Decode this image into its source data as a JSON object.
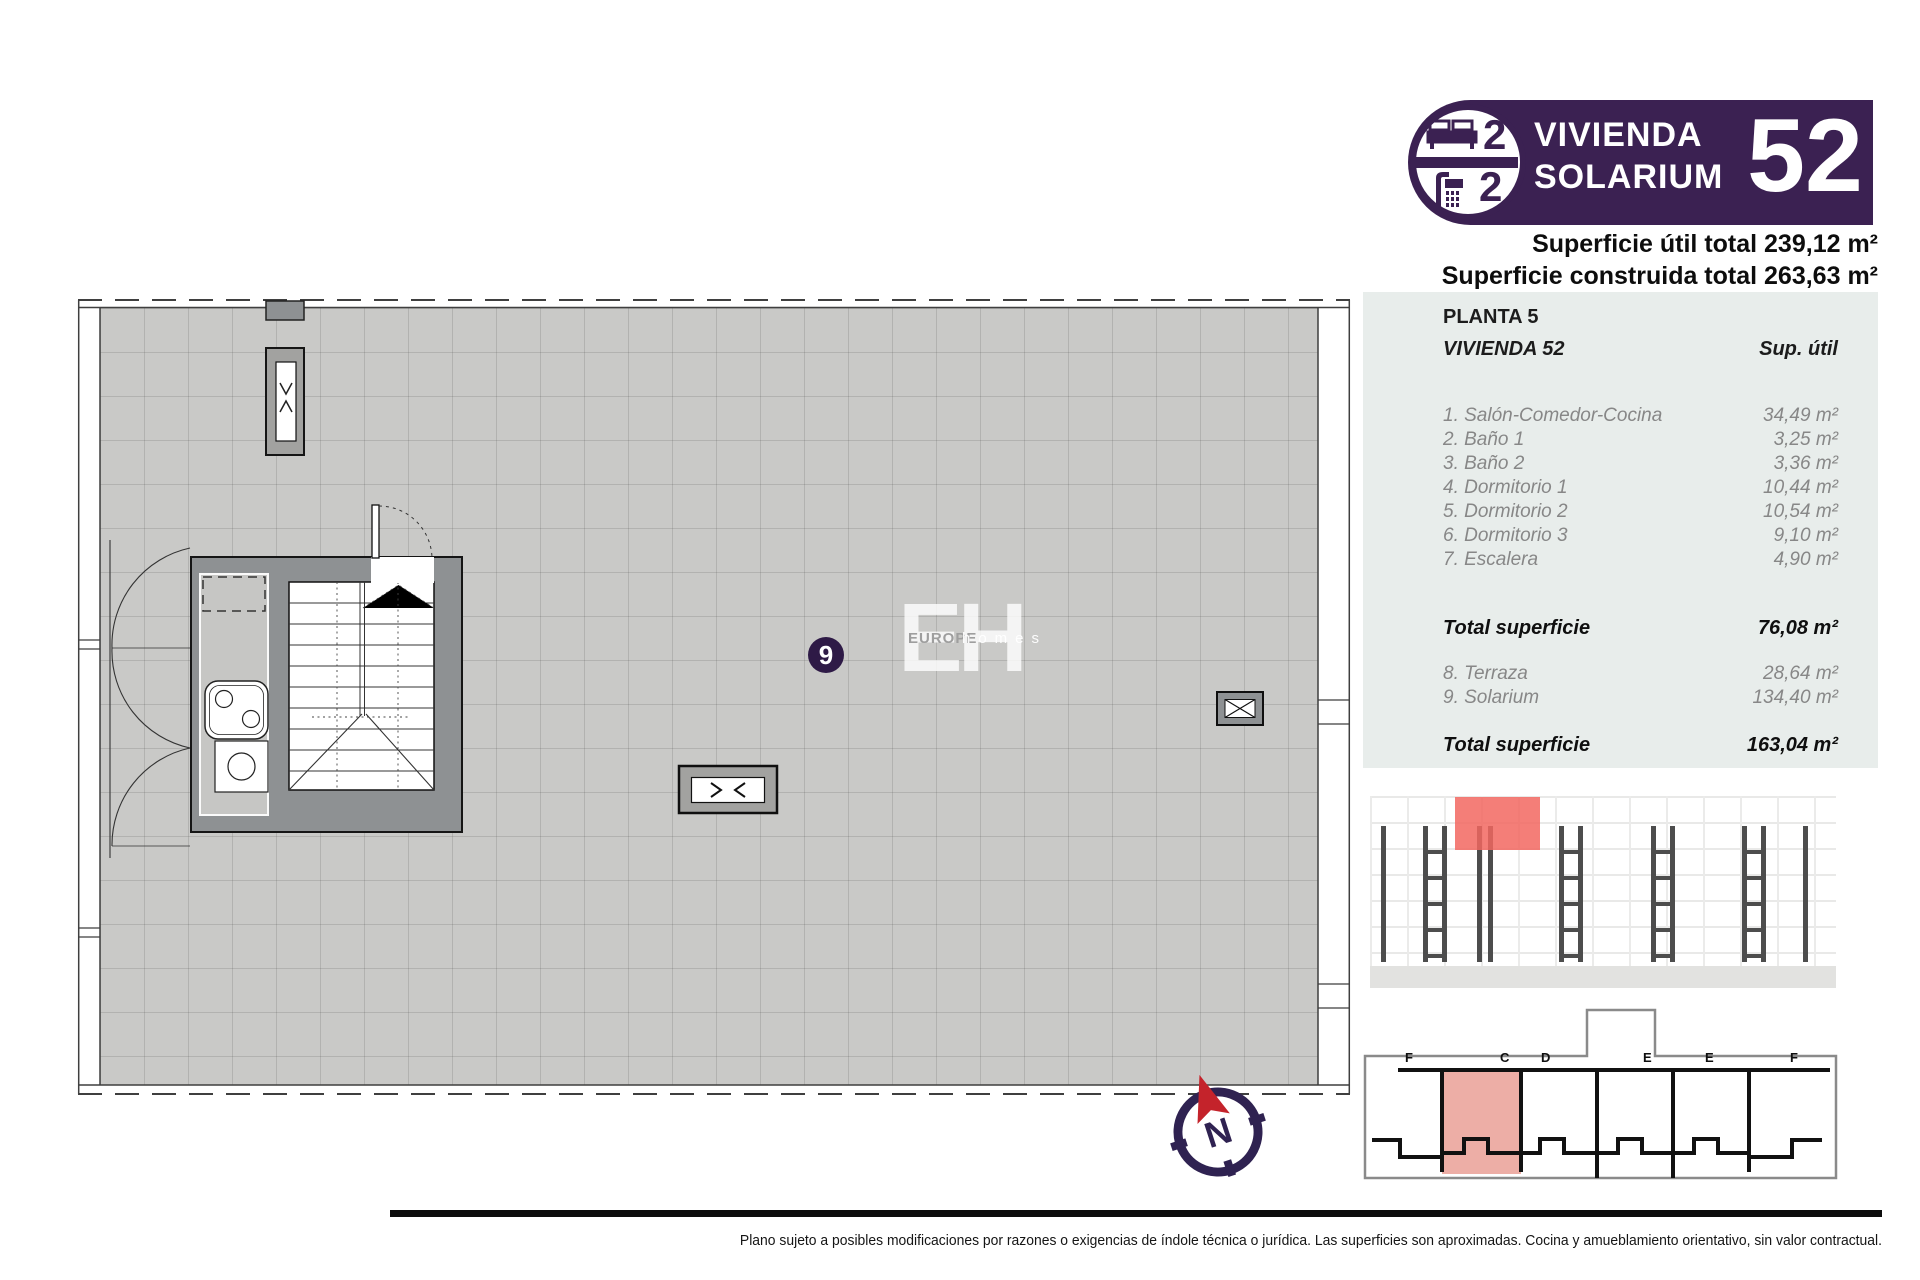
{
  "badge": {
    "bedrooms": "2",
    "bathrooms": "2",
    "title_line1": "VIVIENDA",
    "title_line2": "SOLARIUM",
    "number": "52"
  },
  "totals": {
    "util": "Superficie útil total 239,12 m²",
    "construida": "Superficie construida total 263,63 m²"
  },
  "table": {
    "floor": "PLANTA 5",
    "unit": "VIVIENDA 52",
    "column": "Sup. útil",
    "rooms": [
      {
        "label": "1. Salón-Comedor-Cocina",
        "area": "34,49 m²"
      },
      {
        "label": "2. Baño 1",
        "area": "3,25 m²"
      },
      {
        "label": "3. Baño 2",
        "area": "3,36 m²"
      },
      {
        "label": "4. Dormitorio 1",
        "area": "10,44 m²"
      },
      {
        "label": "5. Dormitorio 2",
        "area": "10,54 m²"
      },
      {
        "label": "6. Dormitorio 3",
        "area": "9,10 m²"
      },
      {
        "label": "7. Escalera",
        "area": "4,90 m²"
      }
    ],
    "subtotal": {
      "label": "Total superficie",
      "value": "76,08 m²"
    },
    "extras": [
      {
        "label": "8. Terraza",
        "area": "28,64 m²"
      },
      {
        "label": "9. Solarium",
        "area": "134,40 m²"
      }
    ],
    "total": {
      "label": "Total superficie",
      "value": "163,04 m²"
    }
  },
  "plan": {
    "room_marker": "9",
    "watermark_initials": "EH",
    "watermark_word1": "EUROPE",
    "watermark_word2": "homes"
  },
  "keyplan": {
    "letters": [
      "F",
      "C",
      "D",
      "E",
      "E",
      "F"
    ]
  },
  "compass": {
    "label": "N"
  },
  "footer": {
    "disclaimer": "Plano sujeto a posibles modificaciones por razones o exigencias de índole técnica o jurídica. Las superficies son aproximadas. Cocina y amueblamiento orientativo, sin valor contractual."
  },
  "colors": {
    "accent_purple": "#3b2152",
    "elevation_highlight": "#f2675f",
    "keyplan_highlight": "#edaea6",
    "compass_arrow_red": "#c4232b",
    "plan_floor_gray": "#c9c9c7",
    "core_wall_gray": "#8e9193",
    "panel_gray": "#e8edeb"
  }
}
